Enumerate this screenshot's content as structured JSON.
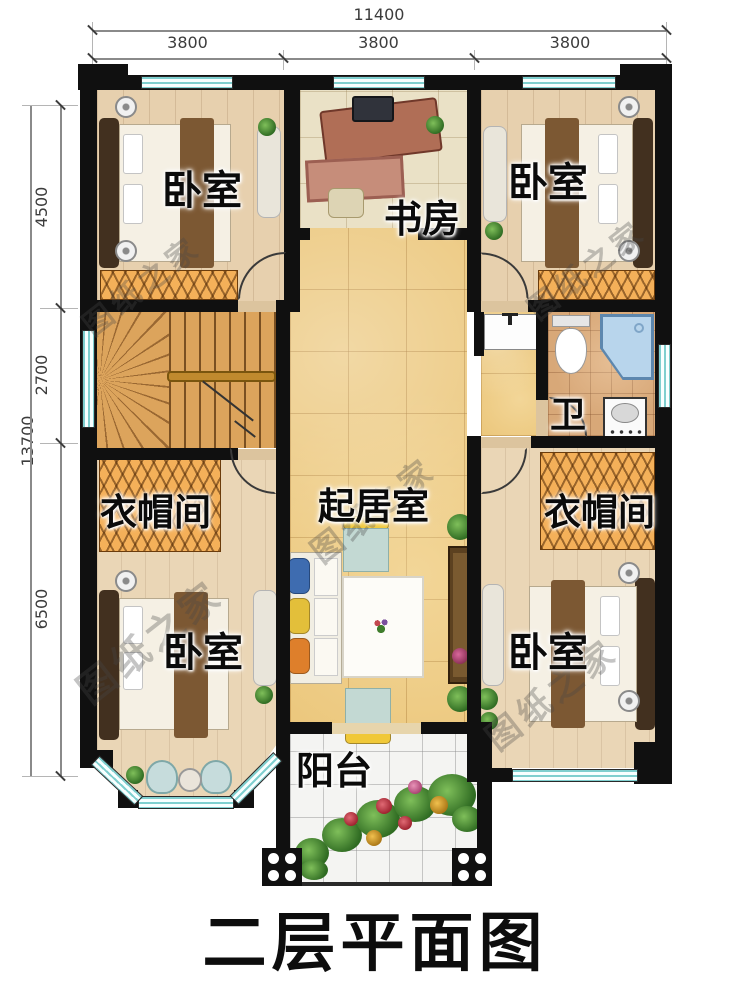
{
  "title": {
    "text": "二层平面图"
  },
  "watermark": {
    "text": "图纸之家"
  },
  "dimensions": {
    "top_total": "11400",
    "top_segments": [
      "3800",
      "3800",
      "3800"
    ],
    "left_total": "13700",
    "left_segments": [
      "4500",
      "2700",
      "6500"
    ]
  },
  "rooms": {
    "bedroom_top_left": "卧室",
    "study": "书房",
    "bedroom_top_right": "卧室",
    "bath": "卫",
    "cloakroom_left": "衣帽间",
    "living": "起居室",
    "cloakroom_right": "衣帽间",
    "bedroom_bottom_left": "卧室",
    "bedroom_bottom_right": "卧室",
    "balcony": "阳台"
  },
  "colors": {
    "wall": "#101010",
    "window_teal": "#7fcfcf",
    "marble_floor": "#ecc87e",
    "wood_floor": "#e7d0ae",
    "wardrobe_hatch": "#f4b059",
    "stair_wood": "#dca45c",
    "bath_tile": "#d8a878",
    "balcony_tile": "#f4f4f2",
    "label_text": "#0b0b0b"
  }
}
